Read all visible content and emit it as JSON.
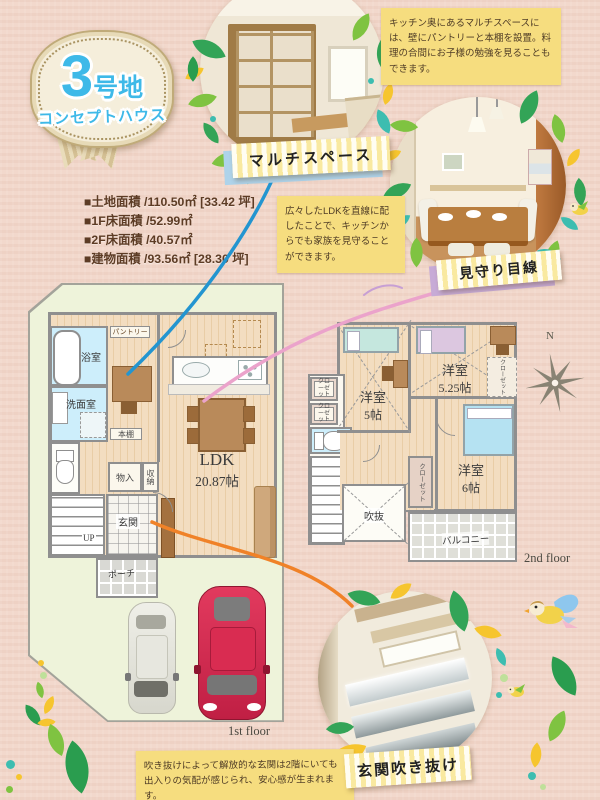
{
  "badge": {
    "number": "3",
    "lot_label": "号地",
    "house_label": "コンセプトハウス"
  },
  "notes": {
    "multispace": "キッチン奥にあるマルチスペースには、壁にパントリーと本棚を設置。料理の合間にお子様の勉強を見ることもできます。",
    "ldk": "広々したLDKを直線に配したことで、キッチンからでも家族を見守ることができます。",
    "entrance": "吹き抜けによって解放的な玄関は2階にいても出入りの気配が感じられ、安心感が生まれます。"
  },
  "tags": {
    "multispace": "マルチスペース",
    "watching": "見守り目線",
    "entrance_void": "玄関吹き抜け"
  },
  "areas": [
    {
      "text": "■土地面積 /110.50㎡ [33.42 坪]"
    },
    {
      "text": "■1F床面積 /52.99㎡"
    },
    {
      "text": "■2F床面積 /40.57㎡"
    },
    {
      "text": "■建物面積 /93.56㎡ [28.30 坪]"
    }
  ],
  "plan1f": {
    "caption": "1st floor",
    "bath": "浴室",
    "washroom": "洗面室",
    "pantry": "パントリー",
    "bookshelf": "本棚",
    "ldk_name": "LDK",
    "ldk_size": "20.87帖",
    "storage_mono": "物入",
    "storage_shuno": "収納",
    "entrance": "玄関",
    "stairs_up": "UP",
    "porch": "ポーチ"
  },
  "plan2f": {
    "caption": "2nd floor",
    "compass_n": "N",
    "dn": "DN",
    "void_label": "吹抜",
    "balcony": "バルコニー",
    "room5_name": "洋室",
    "room5_size": "5帖",
    "room525_name": "洋室",
    "room525_size": "5.25帖",
    "room6_name": "洋室",
    "room6_size": "6帖",
    "closet": "クローゼット"
  },
  "colors": {
    "accent_blue": "#3eb9e8",
    "line_blue": "#2395d0",
    "line_pink": "#eba3cb",
    "line_orange": "#f08228",
    "note_yellow": "#f6dd7f"
  }
}
